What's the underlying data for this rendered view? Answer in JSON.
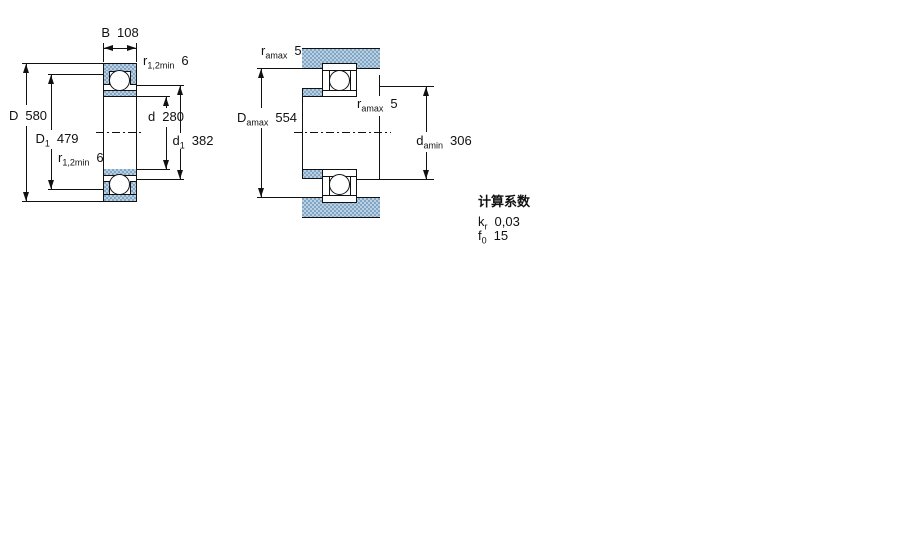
{
  "figure_type": "bearing-dimension-drawing",
  "left_figure": {
    "name": "boundary-dimensions",
    "labels": {
      "B": {
        "sym": "B",
        "sub": "",
        "value": "108"
      },
      "r12min_top": {
        "sym": "r",
        "sub": "1,2min",
        "value": "6"
      },
      "D": {
        "sym": "D",
        "sub": "",
        "value": "580"
      },
      "D1": {
        "sym": "D",
        "sub": "1",
        "value": "479"
      },
      "d": {
        "sym": "d",
        "sub": "",
        "value": "280"
      },
      "d1": {
        "sym": "d",
        "sub": "1",
        "value": "382"
      },
      "r12min_bottom": {
        "sym": "r",
        "sub": "1,2min",
        "value": "6"
      }
    }
  },
  "right_figure": {
    "name": "abutment-and-fillet-dimensions",
    "labels": {
      "ramax_top": {
        "sym": "r",
        "sub": "amax",
        "value": "5"
      },
      "Damax": {
        "sym": "D",
        "sub": "amax",
        "value": "554"
      },
      "ramax_mid": {
        "sym": "r",
        "sub": "amax",
        "value": "5"
      },
      "damin": {
        "sym": "d",
        "sub": "amin",
        "value": "306"
      }
    }
  },
  "calculation_factors": {
    "heading": "计算系数",
    "rows": [
      {
        "sym": "k",
        "sub": "r",
        "value": "0,03"
      },
      {
        "sym": "f",
        "sub": "0",
        "value": "15"
      }
    ]
  },
  "colors": {
    "steel_blue": "#bbd1e2",
    "steel_dot": "#7ba1c2",
    "line_color": "#111111",
    "background": "#ffffff"
  }
}
